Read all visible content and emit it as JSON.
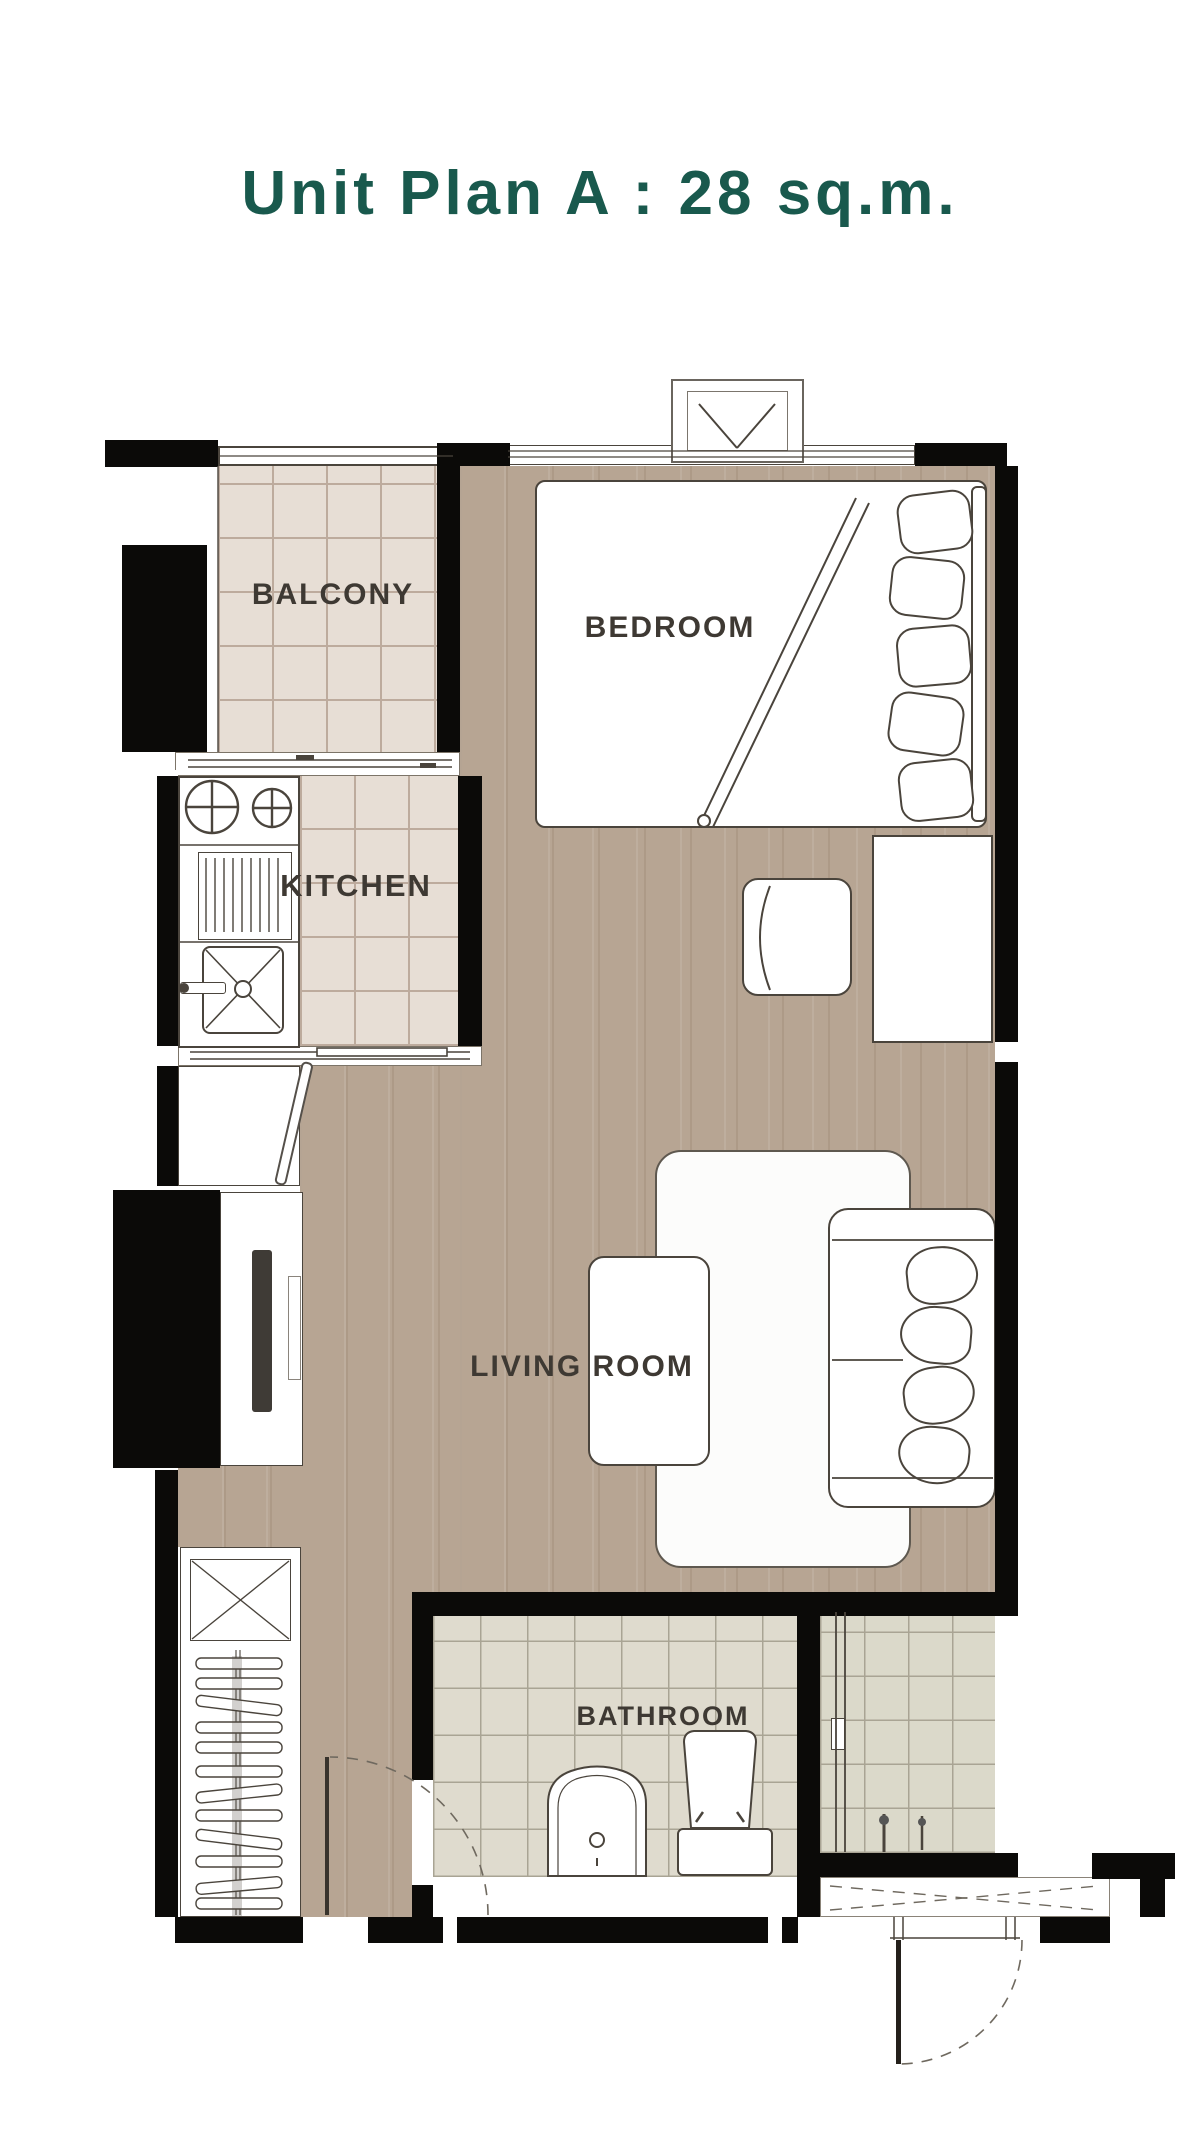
{
  "title": {
    "text": "Unit Plan A : 28 sq.m.",
    "color": "#19594d"
  },
  "rooms": {
    "balcony": {
      "label": "BALCONY",
      "floor": "beige-tile"
    },
    "bedroom": {
      "label": "BEDROOM",
      "floor": "wood"
    },
    "kitchen": {
      "label": "KITCHEN",
      "floor": "beige-tile"
    },
    "living_room": {
      "label": "LIVING ROOM",
      "floor": "wood"
    },
    "bathroom": {
      "label": "BATHROOM",
      "floor": "gray-tile"
    }
  },
  "fixtures": [
    "ac-unit",
    "window",
    "balcony-railing",
    "sliding-door",
    "stove-burners",
    "dish-rack",
    "kitchen-sink",
    "utility-closet",
    "tv-console",
    "tv",
    "wardrobe",
    "clothes-hangers",
    "bed",
    "pillows",
    "blanket-fold",
    "desk",
    "chair",
    "rug",
    "coffee-table",
    "sofa",
    "sofa-cushions",
    "wash-basin",
    "toilet",
    "shower-screen",
    "shower-mixer",
    "entrance-threshold",
    "entrance-door",
    "door-swing-arc"
  ],
  "colors": {
    "wall": "#0b0a08",
    "wood_floor": "#b7a593",
    "balcony_tile": "#e7ded5",
    "bathroom_tile": "#dfdbce",
    "shower_tile": "#dbd9ca",
    "outline": "#4a443c",
    "label_text": "#3e3933",
    "title_text": "#19594d"
  }
}
